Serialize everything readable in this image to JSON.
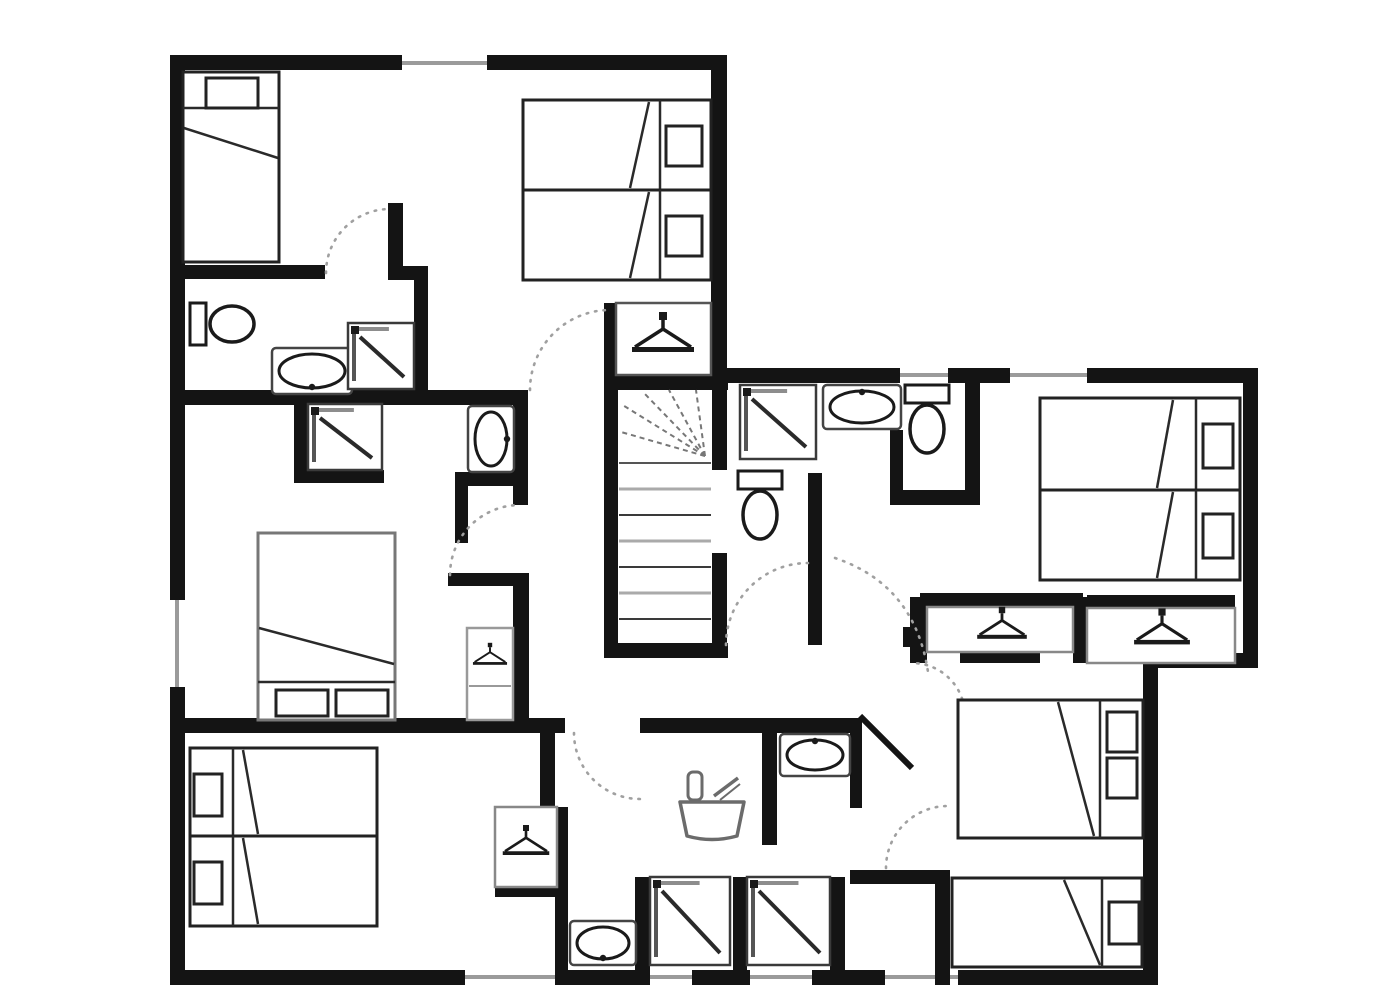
{
  "title": "upper-floor-plan",
  "canvas": {
    "w": 1399,
    "h": 1000,
    "bg": "#ffffff",
    "wall_color": "#141414",
    "furniture_stroke": "#222222",
    "gray": "#999999",
    "arc_color": "#a0a0a0",
    "tread_dark": "#3a3a3a",
    "tread_light": "#aaaaaa"
  },
  "walls": [
    {
      "name": "exterior-top-wall-a",
      "x": 170,
      "y": 55,
      "w": 232,
      "h": 15
    },
    {
      "name": "exterior-top-wall-b",
      "x": 487,
      "y": 55,
      "w": 240,
      "h": 15
    },
    {
      "name": "leftwing-right-wall",
      "x": 711,
      "y": 55,
      "w": 16,
      "h": 320
    },
    {
      "name": "rightwing-top-wall-a",
      "x": 711,
      "y": 368,
      "w": 189,
      "h": 15
    },
    {
      "name": "rightwing-top-wall-b",
      "x": 948,
      "y": 368,
      "w": 62,
      "h": 15
    },
    {
      "name": "rightwing-top-wall-c",
      "x": 1087,
      "y": 368,
      "w": 171,
      "h": 15
    },
    {
      "name": "exterior-right-wall-upper",
      "x": 1243,
      "y": 368,
      "w": 15,
      "h": 300
    },
    {
      "name": "exterior-step-wall",
      "x": 1158,
      "y": 653,
      "w": 100,
      "h": 15
    },
    {
      "name": "exterior-right-wall-lower",
      "x": 1143,
      "y": 653,
      "w": 15,
      "h": 332
    },
    {
      "name": "exterior-bottom-wall-a",
      "x": 170,
      "y": 970,
      "w": 295,
      "h": 15
    },
    {
      "name": "exterior-bottom-wall-b",
      "x": 558,
      "y": 970,
      "w": 89,
      "h": 15
    },
    {
      "name": "exterior-bottom-wall-c",
      "x": 692,
      "y": 970,
      "w": 58,
      "h": 15
    },
    {
      "name": "exterior-bottom-wall-d",
      "x": 812,
      "y": 970,
      "w": 73,
      "h": 15
    },
    {
      "name": "exterior-bottom-wall-e",
      "x": 958,
      "y": 970,
      "w": 200,
      "h": 15
    },
    {
      "name": "exterior-left-wall-a",
      "x": 170,
      "y": 55,
      "w": 15,
      "h": 545
    },
    {
      "name": "exterior-left-wall-b",
      "x": 170,
      "y": 687,
      "w": 15,
      "h": 298
    },
    {
      "name": "hall-top-wall",
      "x": 170,
      "y": 390,
      "w": 358,
      "h": 15
    },
    {
      "name": "ensuite1-top-wall",
      "x": 182,
      "y": 265,
      "w": 143,
      "h": 14
    },
    {
      "name": "ensuite1-door-stub",
      "x": 388,
      "y": 203,
      "w": 15,
      "h": 77
    },
    {
      "name": "ensuite1-corner-wall",
      "x": 388,
      "y": 266,
      "w": 40,
      "h": 14
    },
    {
      "name": "ensuite1-right-wall",
      "x": 414,
      "y": 266,
      "w": 14,
      "h": 126
    },
    {
      "name": "basin-niche-right-wall",
      "x": 513,
      "y": 390,
      "w": 15,
      "h": 115
    },
    {
      "name": "basin-niche-bottom-wall",
      "x": 455,
      "y": 472,
      "w": 58,
      "h": 14
    },
    {
      "name": "basin-niche-left-wall",
      "x": 455,
      "y": 486,
      "w": 13,
      "h": 57
    },
    {
      "name": "shower-alcove-left-wall",
      "x": 294,
      "y": 400,
      "w": 14,
      "h": 77
    },
    {
      "name": "shower-alcove-bottom-wall",
      "x": 294,
      "y": 470,
      "w": 90,
      "h": 13
    },
    {
      "name": "hall-mid-wall",
      "x": 448,
      "y": 573,
      "w": 75,
      "h": 13
    },
    {
      "name": "hall-mid-wall-vertical",
      "x": 513,
      "y": 573,
      "w": 16,
      "h": 157
    },
    {
      "name": "stairwell-top-wall",
      "x": 604,
      "y": 375,
      "w": 124,
      "h": 15
    },
    {
      "name": "stairwell-left-wall",
      "x": 604,
      "y": 390,
      "w": 14,
      "h": 268
    },
    {
      "name": "stairwell-bottom-wall",
      "x": 604,
      "y": 643,
      "w": 124,
      "h": 15
    },
    {
      "name": "stairwell-right-wall-upper",
      "x": 712,
      "y": 375,
      "w": 15,
      "h": 95
    },
    {
      "name": "stairwell-right-wall-lower",
      "x": 712,
      "y": 553,
      "w": 15,
      "h": 105
    },
    {
      "name": "stairs-wardrobe-left-wall",
      "x": 604,
      "y": 303,
      "w": 12,
      "h": 72
    },
    {
      "name": "wc-divider-wall",
      "x": 808,
      "y": 473,
      "w": 14,
      "h": 172
    },
    {
      "name": "toilet-compartment-wall",
      "x": 890,
      "y": 430,
      "w": 13,
      "h": 75
    },
    {
      "name": "bath2-bottom-wall",
      "x": 890,
      "y": 490,
      "w": 90,
      "h": 15
    },
    {
      "name": "bath2-right-wall",
      "x": 965,
      "y": 383,
      "w": 15,
      "h": 122
    },
    {
      "name": "lower-corridor-wall-a",
      "x": 170,
      "y": 718,
      "w": 395,
      "h": 15
    },
    {
      "name": "lower-corridor-wall-b",
      "x": 640,
      "y": 718,
      "w": 213,
      "h": 15
    },
    {
      "name": "tubroom-right-wall",
      "x": 850,
      "y": 718,
      "w": 12,
      "h": 90
    },
    {
      "name": "bedroom4-corridor-wall",
      "x": 850,
      "y": 870,
      "w": 85,
      "h": 14
    },
    {
      "name": "bedroom4-left-wall",
      "x": 935,
      "y": 870,
      "w": 15,
      "h": 115
    },
    {
      "name": "shower-stall-wall-a",
      "x": 635,
      "y": 877,
      "w": 15,
      "h": 108
    },
    {
      "name": "shower-stall-wall-b",
      "x": 733,
      "y": 877,
      "w": 14,
      "h": 108
    },
    {
      "name": "shower-stall-wall-c",
      "x": 830,
      "y": 877,
      "w": 15,
      "h": 108
    },
    {
      "name": "vestibule-left-wall",
      "x": 540,
      "y": 733,
      "w": 15,
      "h": 74
    },
    {
      "name": "bedroom3-right-wall",
      "x": 555,
      "y": 807,
      "w": 13,
      "h": 178
    },
    {
      "name": "tubroom-split-wall",
      "x": 762,
      "y": 733,
      "w": 15,
      "h": 112
    },
    {
      "name": "wardrobe-row-left-wall",
      "x": 910,
      "y": 597,
      "w": 17,
      "h": 66
    },
    {
      "name": "wardrobe-row-door-nub",
      "x": 903,
      "y": 627,
      "w": 7,
      "h": 20
    },
    {
      "name": "wardrobe-row-top-wall-a",
      "x": 920,
      "y": 593,
      "w": 163,
      "h": 14
    },
    {
      "name": "wardrobe-row-divider",
      "x": 1073,
      "y": 597,
      "w": 14,
      "h": 66
    },
    {
      "name": "wardrobe-row-top-wall-b",
      "x": 1087,
      "y": 595,
      "w": 148,
      "h": 13
    },
    {
      "name": "wardrobe-row-bottom-wall",
      "x": 1073,
      "y": 650,
      "w": 107,
      "h": 13
    },
    {
      "name": "wardrobe3-bottom-wall",
      "x": 495,
      "y": 883,
      "w": 63,
      "h": 14
    },
    {
      "name": "wardrobe-row-bottom-ledge",
      "x": 960,
      "y": 650,
      "w": 80,
      "h": 13
    }
  ],
  "windows": [
    {
      "name": "window-top",
      "x1": 402,
      "y1": 63,
      "x2": 487,
      "y2": 63
    },
    {
      "name": "window-wingtop-a",
      "x1": 900,
      "y1": 375,
      "x2": 948,
      "y2": 375
    },
    {
      "name": "window-wingtop-b",
      "x1": 1010,
      "y1": 375,
      "x2": 1087,
      "y2": 375
    },
    {
      "name": "window-left",
      "x1": 177,
      "y1": 600,
      "x2": 177,
      "y2": 687
    },
    {
      "name": "window-bottom-a",
      "x1": 465,
      "y1": 977,
      "x2": 558,
      "y2": 977
    },
    {
      "name": "window-bottom-b",
      "x1": 647,
      "y1": 977,
      "x2": 692,
      "y2": 977
    },
    {
      "name": "window-bottom-c",
      "x1": 750,
      "y1": 977,
      "x2": 812,
      "y2": 977
    },
    {
      "name": "window-bottom-d",
      "x1": 885,
      "y1": 977,
      "x2": 958,
      "y2": 977
    }
  ],
  "beds": [
    {
      "name": "bed-single-top-left",
      "x": 183,
      "y": 72,
      "w": 96,
      "h": 190,
      "stroke": "#222222",
      "pillows": [
        {
          "x": 206,
          "y": 78,
          "w": 52,
          "h": 30
        }
      ],
      "lines": [
        [
          183,
          108,
          279,
          108
        ],
        [
          184,
          128,
          278,
          158
        ]
      ]
    },
    {
      "name": "bed-twin-top-a",
      "x": 523,
      "y": 100,
      "w": 188,
      "h": 90,
      "stroke": "#222222",
      "pillows": [
        {
          "x": 666,
          "y": 126,
          "w": 36,
          "h": 40
        }
      ],
      "lines": [
        [
          660,
          100,
          660,
          190
        ],
        [
          649,
          102,
          630,
          188
        ]
      ]
    },
    {
      "name": "bed-twin-top-b",
      "x": 523,
      "y": 190,
      "w": 188,
      "h": 90,
      "stroke": "#222222",
      "pillows": [
        {
          "x": 666,
          "y": 216,
          "w": 36,
          "h": 40
        }
      ],
      "lines": [
        [
          660,
          190,
          660,
          280
        ],
        [
          649,
          192,
          630,
          278
        ]
      ]
    },
    {
      "name": "bed-double-middle-left",
      "x": 258,
      "y": 533,
      "w": 137,
      "h": 187,
      "stroke": "#777777",
      "pillows": [
        {
          "x": 276,
          "y": 690,
          "w": 52,
          "h": 26
        },
        {
          "x": 336,
          "y": 690,
          "w": 52,
          "h": 26
        }
      ],
      "lines": [
        [
          259,
          628,
          394,
          664
        ],
        [
          258,
          682,
          395,
          682
        ]
      ]
    },
    {
      "name": "bed-twin-bottom-left-a",
      "x": 190,
      "y": 748,
      "w": 187,
      "h": 88,
      "stroke": "#222222",
      "pillows": [
        {
          "x": 194,
          "y": 774,
          "w": 28,
          "h": 42
        }
      ],
      "lines": [
        [
          233,
          748,
          233,
          836
        ],
        [
          243,
          750,
          258,
          834
        ]
      ]
    },
    {
      "name": "bed-twin-bottom-left-b",
      "x": 190,
      "y": 836,
      "w": 187,
      "h": 90,
      "stroke": "#222222",
      "pillows": [
        {
          "x": 194,
          "y": 862,
          "w": 28,
          "h": 42
        }
      ],
      "lines": [
        [
          233,
          836,
          233,
          926
        ],
        [
          243,
          838,
          258,
          924
        ]
      ]
    },
    {
      "name": "bed-twin-top-right-a",
      "x": 1040,
      "y": 398,
      "w": 200,
      "h": 92,
      "stroke": "#222222",
      "pillows": [
        {
          "x": 1203,
          "y": 424,
          "w": 30,
          "h": 44
        }
      ],
      "lines": [
        [
          1196,
          398,
          1196,
          490
        ],
        [
          1173,
          400,
          1157,
          488
        ]
      ]
    },
    {
      "name": "bed-twin-top-right-b",
      "x": 1040,
      "y": 490,
      "w": 200,
      "h": 90,
      "stroke": "#222222",
      "pillows": [
        {
          "x": 1203,
          "y": 514,
          "w": 30,
          "h": 44
        }
      ],
      "lines": [
        [
          1196,
          490,
          1196,
          580
        ],
        [
          1173,
          492,
          1157,
          578
        ]
      ]
    },
    {
      "name": "bed-double-bottom-right",
      "x": 958,
      "y": 700,
      "w": 185,
      "h": 138,
      "stroke": "#222222",
      "pillows": [
        {
          "x": 1107,
          "y": 712,
          "w": 30,
          "h": 40
        },
        {
          "x": 1107,
          "y": 758,
          "w": 30,
          "h": 40
        }
      ],
      "lines": [
        [
          1100,
          700,
          1100,
          838
        ],
        [
          1058,
          702,
          1094,
          836
        ]
      ]
    },
    {
      "name": "bed-single-bottom-right",
      "x": 952,
      "y": 878,
      "w": 190,
      "h": 89,
      "stroke": "#222222",
      "pillows": [
        {
          "x": 1109,
          "y": 902,
          "w": 30,
          "h": 42
        }
      ],
      "lines": [
        [
          1102,
          878,
          1102,
          967
        ],
        [
          1064,
          880,
          1100,
          965
        ]
      ]
    }
  ],
  "wardrobes": [
    {
      "name": "wardrobe-above-stairs",
      "x": 616,
      "y": 303,
      "w": 95,
      "h": 72,
      "stroke": "#555555",
      "hanger": {
        "cx": 663,
        "cy": 336,
        "s": 1.0
      }
    },
    {
      "name": "wardrobe-middle-left",
      "x": 467,
      "y": 628,
      "w": 46,
      "h": 92,
      "stroke": "#999999",
      "hanger": {
        "cx": 490,
        "cy": 656,
        "s": 0.55
      },
      "shelf": [
        469,
        686,
        511,
        686
      ]
    },
    {
      "name": "wardrobe-bottom-left",
      "x": 495,
      "y": 807,
      "w": 62,
      "h": 80,
      "stroke": "#888888",
      "hanger": {
        "cx": 526,
        "cy": 843,
        "s": 0.75
      }
    },
    {
      "name": "wardrobe-top-right-a",
      "x": 927,
      "y": 607,
      "w": 146,
      "h": 45,
      "stroke": "#888888",
      "hanger": {
        "cx": 1002,
        "cy": 626,
        "s": 0.8
      }
    },
    {
      "name": "wardrobe-top-right-b",
      "x": 1087,
      "y": 608,
      "w": 148,
      "h": 55,
      "stroke": "#888888",
      "hanger": {
        "cx": 1162,
        "cy": 630,
        "s": 0.9
      }
    }
  ],
  "toilets": [
    {
      "name": "toilet-ensuite1",
      "x": 190,
      "y": 298,
      "orient": "h"
    },
    {
      "name": "toilet-bath2",
      "x": 903,
      "y": 385,
      "orient": "v"
    },
    {
      "name": "toilet-wc",
      "x": 736,
      "y": 471,
      "orient": "v"
    }
  ],
  "sinks": [
    {
      "name": "sink-ensuite1",
      "x": 272,
      "y": 348,
      "w": 80,
      "h": 46,
      "tap": "bottom"
    },
    {
      "name": "sink-bath2",
      "x": 823,
      "y": 385,
      "w": 78,
      "h": 44,
      "tap": "top"
    },
    {
      "name": "sink-basin-niche",
      "x": 468,
      "y": 406,
      "w": 46,
      "h": 66,
      "tap": "right"
    },
    {
      "name": "sink-tubroom",
      "x": 780,
      "y": 734,
      "w": 70,
      "h": 42,
      "tap": "top"
    },
    {
      "name": "sink-bottom",
      "x": 570,
      "y": 921,
      "w": 66,
      "h": 44,
      "tap": "bottom"
    }
  ],
  "showers": [
    {
      "name": "shower-ensuite1",
      "x": 348,
      "y": 323,
      "w": 66,
      "h": 66
    },
    {
      "name": "shower-alcove",
      "x": 308,
      "y": 404,
      "w": 74,
      "h": 66
    },
    {
      "name": "shower-bath2",
      "x": 740,
      "y": 385,
      "w": 76,
      "h": 74
    },
    {
      "name": "shower-stall-a",
      "x": 650,
      "y": 877,
      "w": 80,
      "h": 88
    },
    {
      "name": "shower-stall-b",
      "x": 747,
      "y": 877,
      "w": 83,
      "h": 88
    }
  ],
  "bathtub": {
    "name": "bathtub",
    "x": 680,
    "y": 770
  },
  "stairs": {
    "name": "staircase",
    "well": {
      "x": 618,
      "y": 390,
      "w": 94,
      "h": 253
    },
    "tread_x1": 619,
    "tread_x2": 711,
    "treads": [
      {
        "y": 463,
        "c": "#555555",
        "w": 2
      },
      {
        "y": 489,
        "c": "#aaaaaa",
        "w": 3
      },
      {
        "y": 515,
        "c": "#3a3a3a",
        "w": 2
      },
      {
        "y": 541,
        "c": "#aaaaaa",
        "w": 3
      },
      {
        "y": 567,
        "c": "#3a3a3a",
        "w": 2
      },
      {
        "y": 593,
        "c": "#aaaaaa",
        "w": 3
      },
      {
        "y": 619,
        "c": "#3a3a3a",
        "w": 2
      }
    ],
    "fan": {
      "cx": 705,
      "cy": 456,
      "points": [
        [
          621,
          432
        ],
        [
          621,
          404
        ],
        [
          643,
          392
        ],
        [
          669,
          390
        ],
        [
          696,
          390
        ]
      ]
    }
  },
  "door_arcs": [
    {
      "name": "door-arc-ensuite1",
      "d": "M 326 273 A 64 64 0 0 1 390 209"
    },
    {
      "name": "door-arc-bedroom1",
      "d": "M 530 390 A 80 80 0 0 1 610 310"
    },
    {
      "name": "door-arc-bedroom2",
      "d": "M 450 575 A 70 70 0 0 1 520 505"
    },
    {
      "name": "door-arc-hall-passage",
      "d": "M 726 645 A 82 82 0 0 1 808 563"
    },
    {
      "name": "door-arc-bedroom-top-right",
      "d": "M 835 558 Q 915 585 928 672"
    },
    {
      "name": "door-arc-bathroom-tub",
      "d": "M 574 733 A 66 66 0 0 0 640 799"
    },
    {
      "name": "door-arc-bedroom-bottom-right",
      "d": "M 886 868 A 62 62 0 0 1 948 806"
    },
    {
      "name": "door-arc-sink-nook",
      "d": "M 965 716 A 53 53 0 0 0 912 663"
    }
  ],
  "door_leaves": [
    {
      "name": "door-leaf-sink-nook",
      "x1": 860,
      "y1": 716,
      "x2": 912,
      "y2": 768
    }
  ]
}
